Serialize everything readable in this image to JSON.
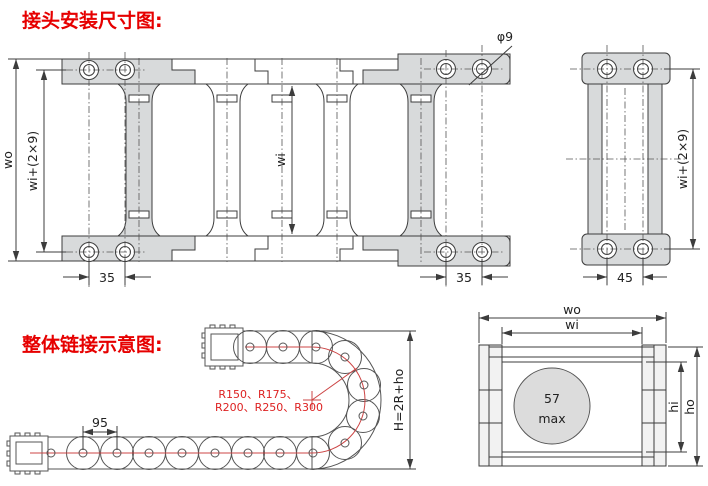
{
  "headings": {
    "top": "接头安装尺寸图:",
    "bottom": "整体链接示意图:"
  },
  "main_view": {
    "dim_wo": "wo",
    "dim_wi_plus": "wi+(2×9)",
    "dim_wi": "wi",
    "dim_pitch_left": "35",
    "dim_pitch_right": "35",
    "dim_hole_dia": "φ9"
  },
  "end_view": {
    "dim_pitch": "45",
    "dim_wi_plus": "wi+(2×9)"
  },
  "schematic": {
    "dim_link_pitch": "95",
    "radii_line1": "R150、R175、",
    "radii_line2": "R200、R250、R300",
    "dim_height": "H=2R+ho"
  },
  "section_view": {
    "dim_wo": "wo",
    "dim_wi": "wi",
    "bore_value": "57",
    "bore_unit": "max",
    "dim_hi": "hi",
    "dim_ho": "ho"
  },
  "colors": {
    "heading_red": "#e60000",
    "drawing_line": "#3c3c3c",
    "bracket_gray": "#d8dadb",
    "centerline_red": "#cc4444",
    "section_circle_gray": "#dcdcdc"
  }
}
